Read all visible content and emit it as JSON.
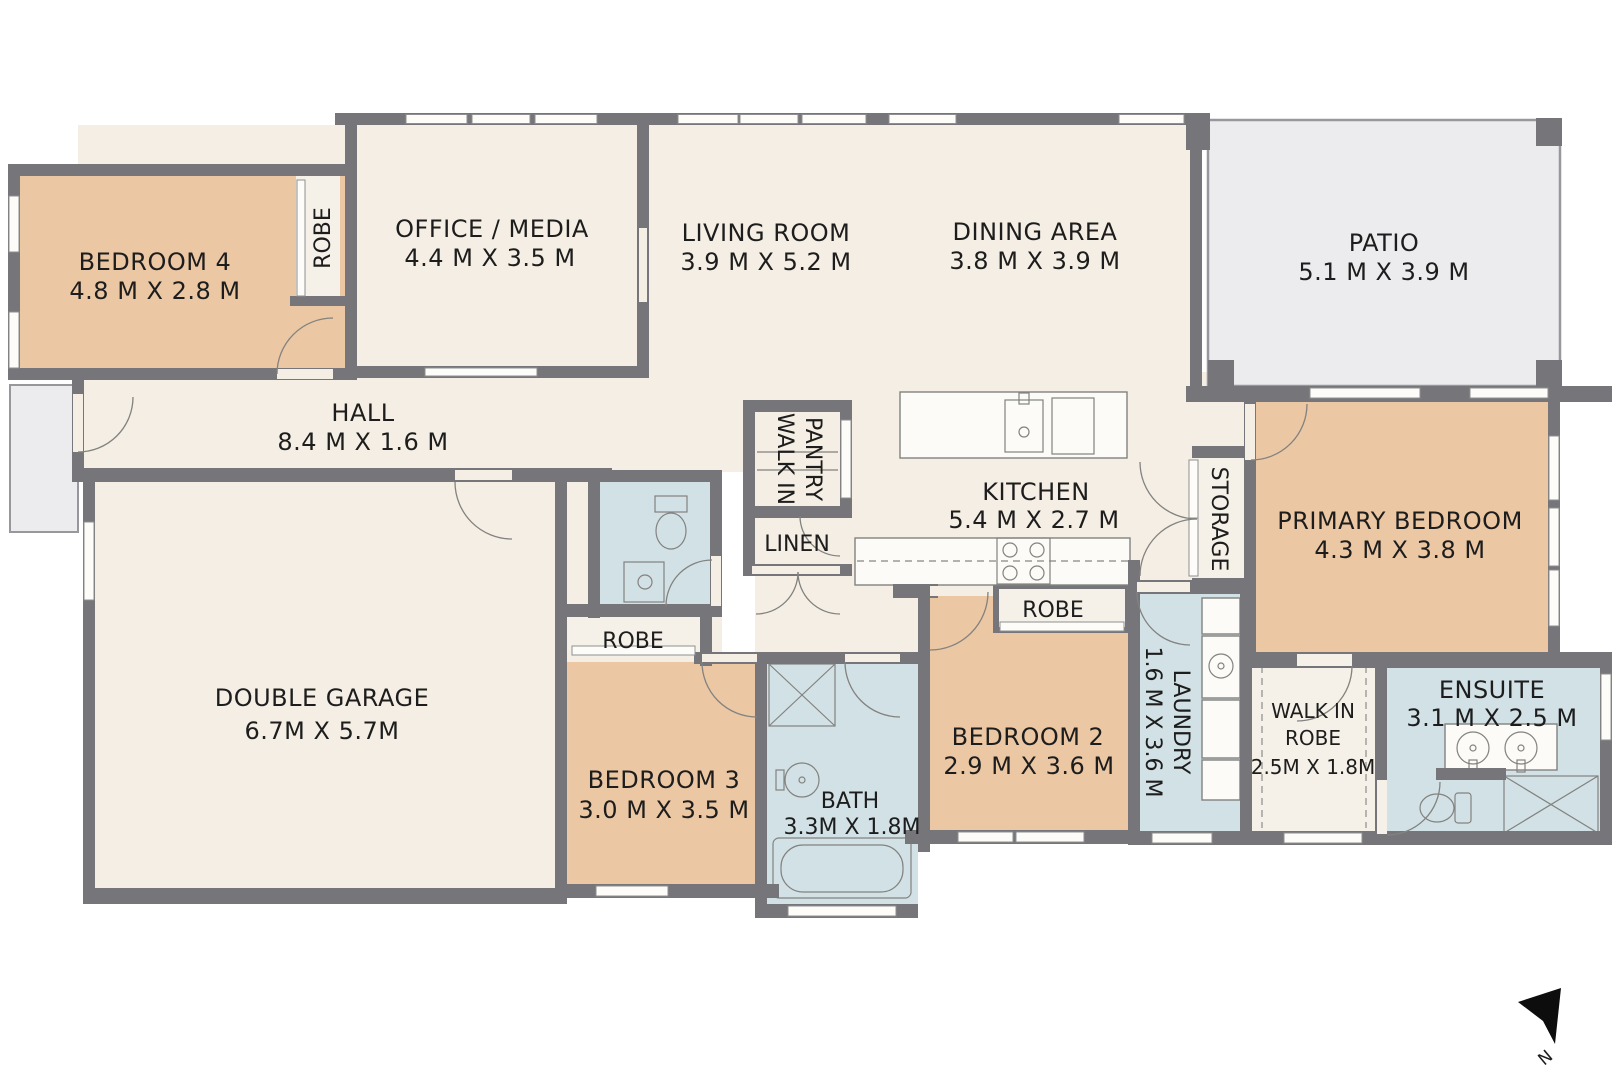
{
  "title": "Residential floor plan",
  "colors": {
    "floor_cream": "#f5eee4",
    "room_tan": "#ebc7a4",
    "room_blue": "#d2e1e6",
    "outdoor_grey": "#ececee",
    "closet_offwhite": "#f6f1e8",
    "wall_grey": "#76767a",
    "text": "#1d1d1d"
  },
  "rooms": {
    "bedroom4": {
      "name": "BEDROOM 4",
      "dims": "4.8 M X 2.8 M"
    },
    "robe4": {
      "name": "ROBE"
    },
    "office": {
      "name": "OFFICE / MEDIA",
      "dims": "4.4 M X 3.5 M"
    },
    "living": {
      "name": "LIVING ROOM",
      "dims": "3.9 M X 5.2 M"
    },
    "dining": {
      "name": "DINING AREA",
      "dims": "3.8 M X 3.9 M"
    },
    "patio": {
      "name": "PATIO",
      "dims": "5.1 M X 3.9 M"
    },
    "hall": {
      "name": "HALL",
      "dims": "8.4 M X 1.6 M"
    },
    "pantry": {
      "line1": "WALK IN",
      "line2": "PANTRY"
    },
    "linen": {
      "name": "LINEN"
    },
    "kitchen": {
      "name": "KITCHEN",
      "dims": "5.4 M X 2.7 M"
    },
    "storage": {
      "name": "STORAGE"
    },
    "primary": {
      "name": "PRIMARY BEDROOM",
      "dims": "4.3 M X 3.8 M"
    },
    "garage": {
      "name": "DOUBLE GARAGE",
      "dims": "6.7M X 5.7M"
    },
    "robe3": {
      "name": "ROBE"
    },
    "bedroom3": {
      "name": "BEDROOM 3",
      "dims": "3.0 M X 3.5 M"
    },
    "bath": {
      "name": "BATH",
      "dims": "3.3M X 1.8M"
    },
    "robe2": {
      "name": "ROBE"
    },
    "bedroom2": {
      "name": "BEDROOM 2",
      "dims": "2.9 M X 3.6 M"
    },
    "laundry": {
      "name": "LAUNDRY",
      "dims": "1.6 M X 3.6 M"
    },
    "wir": {
      "line1": "WALK IN",
      "line2": "ROBE",
      "dims": "2.5M X 1.8M"
    },
    "ensuite": {
      "name": "ENSUITE",
      "dims": "3.1 M X 2.5 M"
    }
  },
  "compass": {
    "label": "N"
  }
}
